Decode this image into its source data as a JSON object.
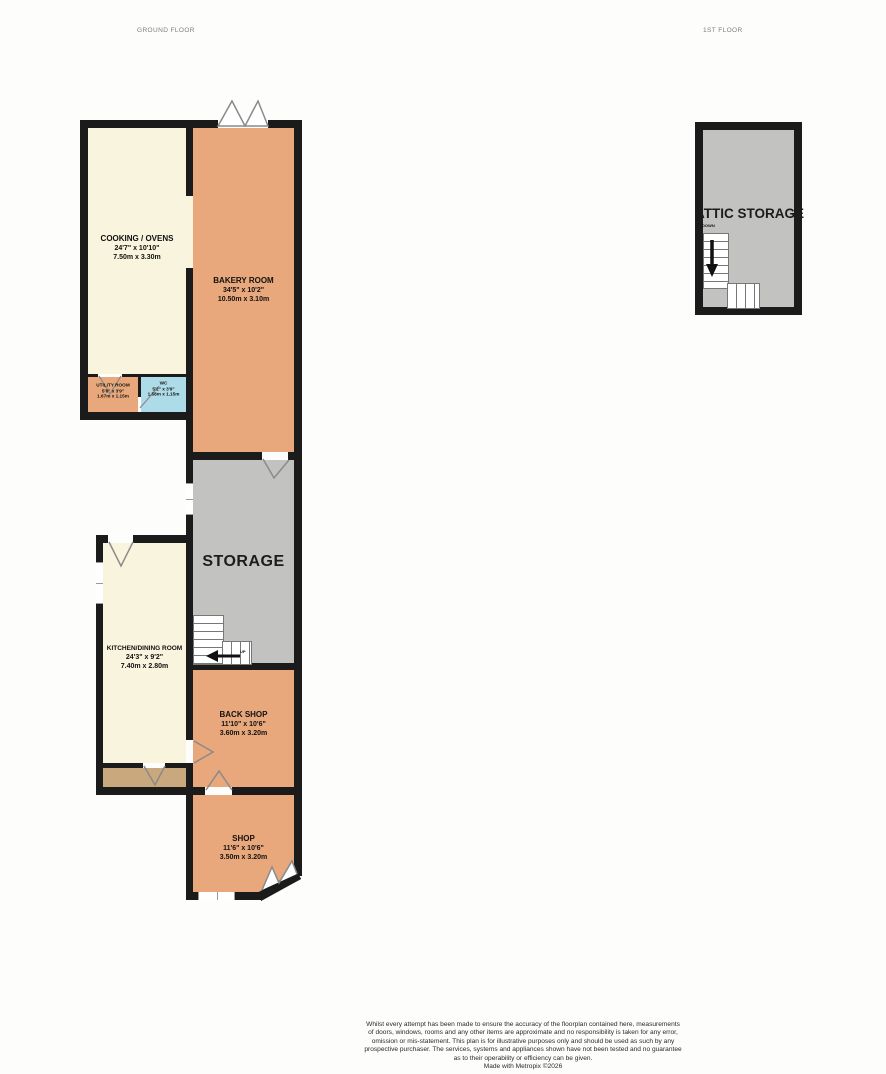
{
  "floors": {
    "ground": {
      "label": "GROUND FLOOR"
    },
    "first": {
      "label": "1ST FLOOR"
    }
  },
  "rooms": {
    "cooking_ovens": {
      "name": "COOKING / OVENS",
      "imperial": "24'7\" x 10'10\"",
      "metric": "7.50m x 3.30m"
    },
    "bakery_room": {
      "name": "BAKERY ROOM",
      "imperial": "34'5\" x 10'2\"",
      "metric": "10.50m x 3.10m"
    },
    "utility_room": {
      "name": "UTILITY ROOM",
      "imperial": "5'6\" x 3'9\"",
      "metric": "1.67m x 1.15m"
    },
    "wc": {
      "name": "WC",
      "imperial": "5'2\" x 3'9\"",
      "metric": "1.58m x 1.15m"
    },
    "storage": {
      "name": "STORAGE"
    },
    "kitchen_dining": {
      "name": "KITCHEN/DINING ROOM",
      "imperial": "24'3\" x 9'2\"",
      "metric": "7.40m x 2.80m"
    },
    "back_shop": {
      "name": "BACK SHOP",
      "imperial": "11'10\" x 10'6\"",
      "metric": "3.60m x 3.20m"
    },
    "shop": {
      "name": "SHOP",
      "imperial": "11'6\" x 10'6\"",
      "metric": "3.50m x 3.20m"
    },
    "attic_storage": {
      "name": "ATTIC STORAGE"
    }
  },
  "stairs": {
    "up_label": "UP",
    "down_label": "DOWN"
  },
  "colors": {
    "wall": "#1b1b1b",
    "room_cream": "#f8f4dd",
    "room_orange": "#e8a87c",
    "room_gray": "#c2c2c1",
    "room_blue": "#aedbe8",
    "room_brown": "#c9a87e",
    "door_swing_line": "#8a8a8a",
    "floor_label_gray": "#7d7d7d"
  },
  "footer": {
    "disclaimer_lines": [
      "Whilst every attempt has been made to ensure the accuracy of the floorplan contained here, measurements",
      "of doors, windows, rooms and any other items are approximate and no responsibility is taken for any error,",
      "omission or mis-statement. This plan is for illustrative purposes only and should be used as such by any",
      "prospective purchaser. The services, systems and appliances shown have not been tested and no guarantee",
      "as to their operability or efficiency can be given."
    ],
    "credit": "Made with Metropix ©2026"
  }
}
